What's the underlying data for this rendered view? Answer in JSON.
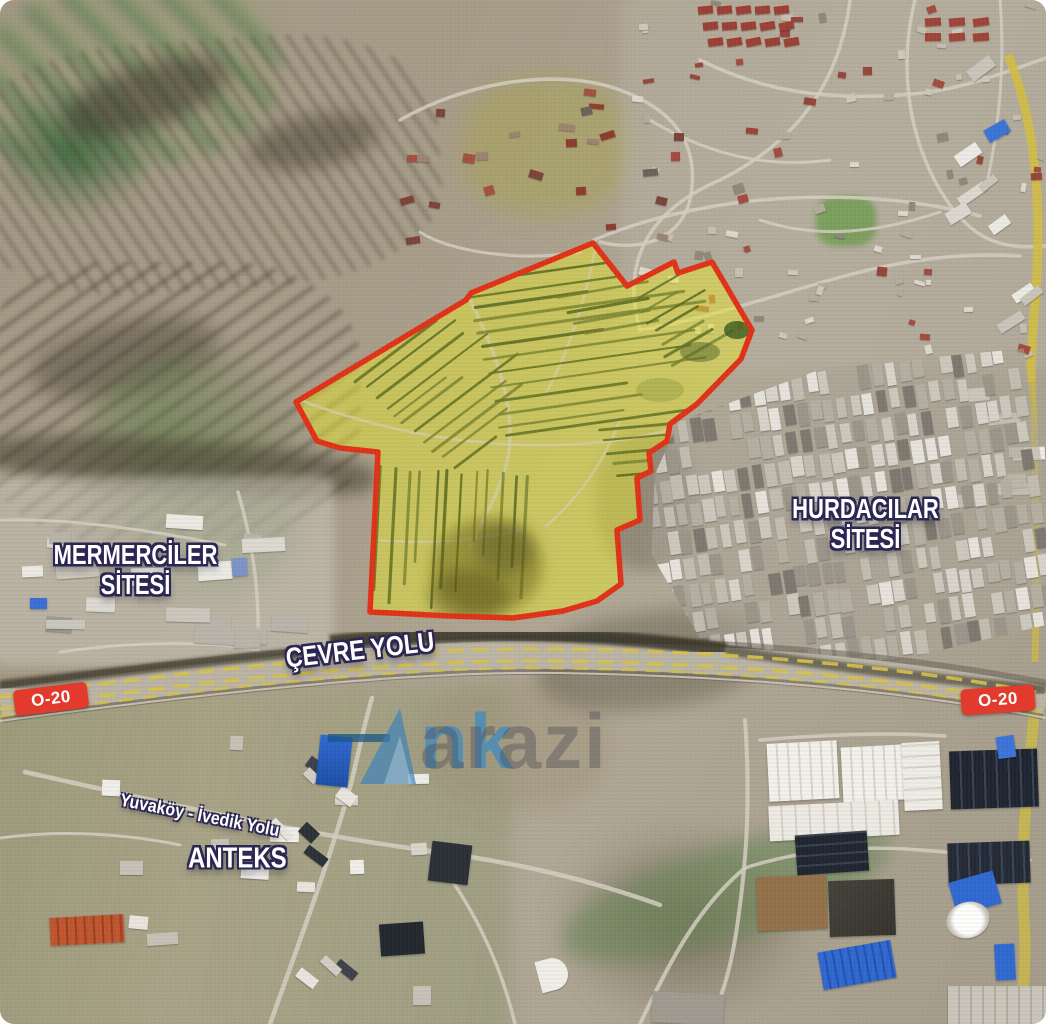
{
  "map_labels": {
    "mermerciler_line1": "MERMERCİLER",
    "mermerciler_line2": "SİTESİ",
    "hurdacilar_line1": "HURDACILAR",
    "hurdacilar_line2": "SİTESİ",
    "anteks": "ANTEKS",
    "cevre_yolu": "ÇEVRE YOLU",
    "yuvakoy_ivedik_yolu": "Yuvaköy - İvedik Yolu",
    "route_badge_left": "O-20",
    "route_badge_right": "O-20"
  },
  "watermark": {
    "brand": "Ankarazi",
    "visible_blue_text": "nk",
    "visible_gray_text": "arazi"
  },
  "parcel_overlay": {
    "fill_color": "#e8e830",
    "fill_opacity": 0.5,
    "border_color": "#e03218",
    "border_width": 5.5,
    "points": [
      [
        593,
        243
      ],
      [
        627,
        286
      ],
      [
        674,
        262
      ],
      [
        678,
        273
      ],
      [
        712,
        262
      ],
      [
        752,
        330
      ],
      [
        741,
        359
      ],
      [
        697,
        404
      ],
      [
        670,
        424
      ],
      [
        667,
        441
      ],
      [
        649,
        453
      ],
      [
        651,
        471
      ],
      [
        637,
        478
      ],
      [
        640,
        520
      ],
      [
        617,
        530
      ],
      [
        621,
        584
      ],
      [
        597,
        601
      ],
      [
        563,
        611
      ],
      [
        513,
        618
      ],
      [
        450,
        616
      ],
      [
        370,
        612
      ],
      [
        378,
        452
      ],
      [
        340,
        448
      ],
      [
        317,
        441
      ],
      [
        296,
        402
      ],
      [
        466,
        300
      ],
      [
        471,
        293
      ]
    ]
  },
  "badge_style": {
    "background_color": "#e23b2e",
    "text_color": "#ffffff"
  },
  "label_style": {
    "text_color": "#ffffff",
    "outline_color": "#2c2752"
  }
}
